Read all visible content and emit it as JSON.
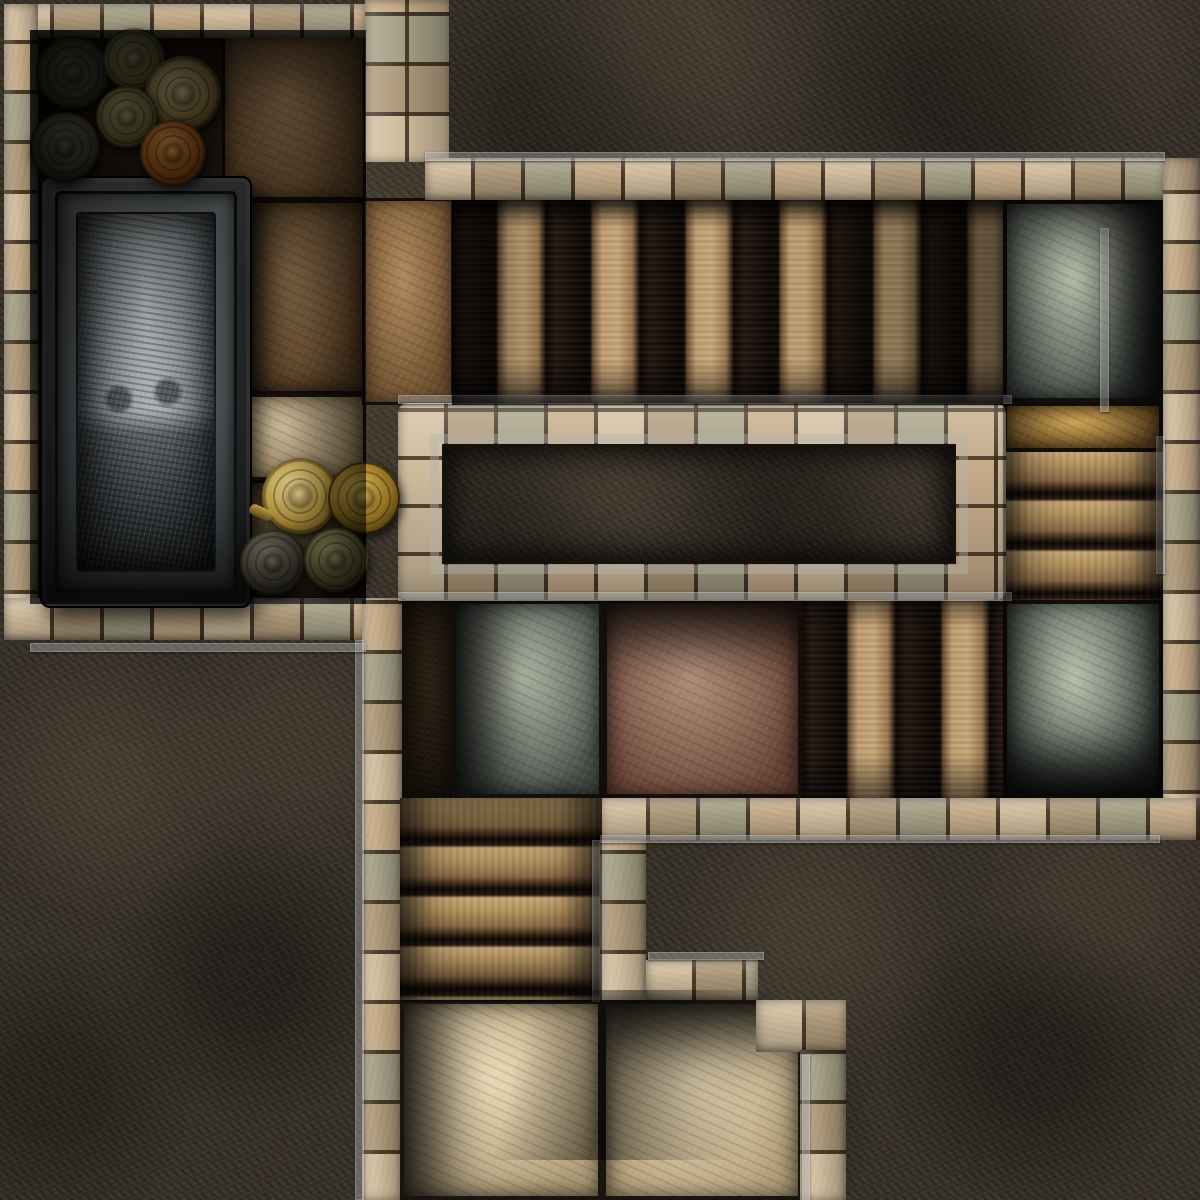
{
  "canvas": {
    "width": 1200,
    "height": 1200
  },
  "map_title": "stone-dungeon-tomb-map",
  "palette": {
    "bedrock": "#3a332a",
    "brick_light": "#d3c1a0",
    "brick_dark": "#a8947a",
    "brick_green": "#8e957f",
    "trim_gray": "#b2b2b2",
    "step_light": "#c8a878",
    "step_gap": "#0d0804",
    "tile_graygreen": "#5d6458",
    "tile_redbrown": "#7c5847",
    "tile_pale": "#cdbd9c",
    "tile_amber": "#8a6a2e",
    "sarcophagus_stone": "#a5acb0",
    "metal_gold": "#c9a94e",
    "metal_bronze": "#8a7340",
    "metal_rust": "#8a4c16"
  },
  "elements": [
    {
      "name": "bedrock",
      "type": "rock",
      "x": 0,
      "y": 0,
      "w": 1200,
      "h": 1200,
      "i": false
    },
    {
      "name": "tomb-room-floor",
      "type": "floor-dark",
      "x": 30,
      "y": 30,
      "w": 336,
      "h": 574,
      "i": false
    },
    {
      "name": "floor-slab-northeast",
      "type": "tile",
      "variant": "slabBrown",
      "x": 222,
      "y": 34,
      "w": 144,
      "h": 166,
      "i": false
    },
    {
      "name": "floor-slab-east",
      "type": "tile",
      "variant": "slabBrown",
      "extra": "shade-left",
      "x": 222,
      "y": 200,
      "w": 144,
      "h": 194,
      "i": false
    },
    {
      "name": "floor-slab-pale",
      "type": "tile",
      "variant": "slabPale",
      "x": 222,
      "y": 394,
      "w": 144,
      "h": 86,
      "i": false
    },
    {
      "name": "floor-slab-southeast",
      "type": "tile",
      "variant": "slabDark",
      "x": 222,
      "y": 480,
      "w": 144,
      "h": 124,
      "i": false
    },
    {
      "name": "corridor-entry-slab",
      "type": "tile",
      "variant": "slabBrown",
      "x": 362,
      "y": 198,
      "w": 92,
      "h": 207,
      "i": false
    },
    {
      "name": "rock-north-field",
      "type": "rock",
      "x": 448,
      "y": 0,
      "w": 752,
      "h": 160,
      "i": false
    },
    {
      "name": "wall-room-top",
      "type": "bricks-h",
      "x": 4,
      "y": 4,
      "w": 362,
      "h": 34,
      "i": false
    },
    {
      "name": "wall-room-left",
      "type": "bricks-v",
      "x": 4,
      "y": 4,
      "w": 34,
      "h": 636,
      "i": false
    },
    {
      "name": "wall-room-right",
      "type": "bricks-v",
      "extra": "grid",
      "x": 365,
      "y": 0,
      "w": 85,
      "h": 162,
      "i": false
    },
    {
      "name": "wall-north-band",
      "type": "bricks-h",
      "x": 425,
      "y": 158,
      "w": 740,
      "h": 42,
      "i": false
    },
    {
      "name": "wall-east",
      "type": "bricks-v",
      "x": 1163,
      "y": 158,
      "w": 37,
      "h": 682,
      "i": false
    },
    {
      "name": "wall-room-bottom",
      "type": "bricks-h",
      "x": 4,
      "y": 598,
      "w": 362,
      "h": 42,
      "i": false
    },
    {
      "name": "wall-west-mid",
      "type": "bricks-v",
      "x": 362,
      "y": 598,
      "w": 40,
      "h": 602,
      "i": false
    },
    {
      "name": "stairs-east-corridor",
      "type": "stairs-v",
      "x": 452,
      "y": 200,
      "w": 551,
      "h": 205,
      "i": false
    },
    {
      "name": "tile-northeast-gray",
      "type": "tile",
      "variant": "graygreen",
      "extra": "shade-right",
      "x": 1003,
      "y": 200,
      "w": 160,
      "h": 202,
      "i": false
    },
    {
      "name": "slab-amber-east",
      "type": "tile",
      "variant": "amber",
      "x": 1003,
      "y": 402,
      "w": 160,
      "h": 50,
      "i": false
    },
    {
      "name": "stairs-east-down",
      "type": "stairs-h",
      "x": 1003,
      "y": 452,
      "w": 160,
      "h": 148,
      "i": false
    },
    {
      "name": "tile-east-gray",
      "type": "tile",
      "variant": "graygreen",
      "extra": "shade-bottom",
      "x": 1003,
      "y": 600,
      "w": 160,
      "h": 198,
      "i": false
    },
    {
      "name": "wall-central-frame",
      "type": "bricks-h",
      "extra": "grid frame",
      "x": 398,
      "y": 403,
      "w": 608,
      "h": 197,
      "i": false
    },
    {
      "name": "trim-central-frame",
      "type": "trimbox",
      "x": 430,
      "y": 434,
      "w": 538,
      "h": 140,
      "i": false
    },
    {
      "name": "rock-central-block",
      "type": "rock",
      "extra": "inset",
      "x": 442,
      "y": 444,
      "w": 514,
      "h": 120,
      "i": false
    },
    {
      "name": "floor-strip-west",
      "type": "floor-dark",
      "x": 402,
      "y": 600,
      "w": 50,
      "h": 198,
      "i": false
    },
    {
      "name": "tile-mid-gray",
      "type": "tile",
      "variant": "graygreen",
      "extra": "shade-left",
      "x": 452,
      "y": 600,
      "w": 151,
      "h": 198,
      "i": false
    },
    {
      "name": "tile-mid-red",
      "type": "tile",
      "variant": "redbrown",
      "extra": "shade-top",
      "x": 603,
      "y": 600,
      "w": 199,
      "h": 198,
      "i": false
    },
    {
      "name": "stairs-mid",
      "type": "stairs-v",
      "x": 802,
      "y": 600,
      "w": 201,
      "h": 198,
      "i": false
    },
    {
      "name": "wall-south-band",
      "type": "bricks-h",
      "x": 600,
      "y": 798,
      "w": 600,
      "h": 42,
      "i": false
    },
    {
      "name": "rock-southeast-field",
      "type": "rock",
      "x": 646,
      "y": 840,
      "w": 554,
      "h": 360,
      "i": false
    },
    {
      "name": "rock-southwest-field",
      "type": "rock",
      "x": 0,
      "y": 640,
      "w": 362,
      "h": 560,
      "i": false
    },
    {
      "name": "stairs-south",
      "type": "stairs-h",
      "x": 400,
      "y": 798,
      "w": 202,
      "h": 204,
      "i": false
    },
    {
      "name": "tile-south-pale-left",
      "type": "tile",
      "variant": "pale",
      "extra": "shade-left",
      "x": 400,
      "y": 1000,
      "w": 202,
      "h": 200,
      "i": false
    },
    {
      "name": "tile-south-pale-right",
      "type": "tile",
      "variant": "pale",
      "extra": "shade-top",
      "x": 602,
      "y": 1000,
      "w": 200,
      "h": 200,
      "i": false
    },
    {
      "name": "wall-step-a",
      "type": "bricks-v",
      "x": 600,
      "y": 840,
      "w": 46,
      "h": 160,
      "i": false
    },
    {
      "name": "wall-step-b",
      "type": "bricks-h",
      "x": 646,
      "y": 960,
      "w": 112,
      "h": 40,
      "i": false
    },
    {
      "name": "wall-step-c",
      "type": "bricks-h",
      "x": 756,
      "y": 1000,
      "w": 90,
      "h": 52,
      "i": false
    },
    {
      "name": "wall-step-d",
      "type": "bricks-v",
      "x": 800,
      "y": 1050,
      "w": 46,
      "h": 150,
      "i": false
    },
    {
      "name": "trim-north-band",
      "type": "trim",
      "x": 425,
      "y": 152,
      "w": 740,
      "h": 9,
      "i": false
    },
    {
      "name": "trim-frame-top",
      "type": "trim",
      "x": 398,
      "y": 395,
      "w": 614,
      "h": 9,
      "i": false
    },
    {
      "name": "trim-frame-bottom",
      "type": "trim",
      "x": 398,
      "y": 592,
      "w": 614,
      "h": 9,
      "i": false
    },
    {
      "name": "trim-west-wall",
      "type": "trim",
      "x": 355,
      "y": 640,
      "w": 9,
      "h": 560,
      "i": false
    },
    {
      "name": "trim-room-bottom",
      "type": "trim",
      "x": 30,
      "y": 643,
      "w": 336,
      "h": 9,
      "i": false
    },
    {
      "name": "trim-south-band",
      "type": "trim",
      "x": 600,
      "y": 835,
      "w": 560,
      "h": 8,
      "i": false
    },
    {
      "name": "trim-step-a",
      "type": "trim",
      "x": 592,
      "y": 840,
      "w": 8,
      "h": 162,
      "i": false
    },
    {
      "name": "trim-step-b",
      "type": "trim",
      "x": 648,
      "y": 952,
      "w": 116,
      "h": 8,
      "i": false
    },
    {
      "name": "trim-step-d",
      "type": "trim",
      "x": 802,
      "y": 1055,
      "w": 8,
      "h": 145,
      "i": false
    },
    {
      "name": "trim-east-wall",
      "type": "trim",
      "x": 1156,
      "y": 436,
      "w": 9,
      "h": 138,
      "i": false
    },
    {
      "name": "trim-east-room",
      "type": "trim",
      "x": 1100,
      "y": 228,
      "w": 9,
      "h": 184,
      "i": false
    },
    {
      "name": "sarcophagus",
      "type": "sarcophagus",
      "x": 40,
      "y": 176,
      "w": 212,
      "h": 432,
      "i": true
    },
    {
      "name": "plate-dark-1",
      "type": "disc",
      "variant": "darkplate",
      "x": 36,
      "y": 36,
      "w": 74,
      "h": 74,
      "i": true
    },
    {
      "name": "urn-green",
      "type": "disc",
      "variant": "green",
      "x": 103,
      "y": 28,
      "w": 62,
      "h": 62,
      "i": true
    },
    {
      "name": "shield-bronze",
      "type": "disc",
      "variant": "bronze",
      "x": 145,
      "y": 56,
      "w": 76,
      "h": 76,
      "i": true
    },
    {
      "name": "plate-green-1",
      "type": "disc",
      "variant": "green",
      "x": 96,
      "y": 86,
      "w": 62,
      "h": 62,
      "i": true
    },
    {
      "name": "plate-dark-2",
      "type": "disc",
      "variant": "darkplate",
      "x": 30,
      "y": 112,
      "w": 70,
      "h": 70,
      "i": true
    },
    {
      "name": "plate-rust",
      "type": "disc",
      "variant": "rust",
      "x": 140,
      "y": 120,
      "w": 66,
      "h": 66,
      "i": true
    },
    {
      "name": "kettle-gold",
      "type": "disc",
      "variant": "gold",
      "extra": "kettle",
      "x": 262,
      "y": 458,
      "w": 76,
      "h": 76,
      "i": true
    },
    {
      "name": "jug-gold",
      "type": "disc",
      "variant": "golddark",
      "x": 328,
      "y": 462,
      "w": 72,
      "h": 72,
      "i": true
    },
    {
      "name": "plate-dark-3",
      "type": "disc",
      "variant": "darkplate",
      "x": 240,
      "y": 530,
      "w": 66,
      "h": 66,
      "i": true
    },
    {
      "name": "plate-green-2",
      "type": "disc",
      "variant": "green",
      "x": 304,
      "y": 528,
      "w": 64,
      "h": 64,
      "i": true
    },
    {
      "name": "shadow-tomb-room",
      "type": "overlay",
      "variant": "room-shadow",
      "x": 30,
      "y": 30,
      "w": 336,
      "h": 574,
      "i": false
    },
    {
      "name": "shadow-east-corridor",
      "type": "overlay",
      "variant": "corridor-shadow",
      "x": 452,
      "y": 200,
      "w": 551,
      "h": 205,
      "i": false
    },
    {
      "name": "shadow-east-column",
      "type": "overlay",
      "variant": "side-shadow",
      "x": 1003,
      "y": 200,
      "w": 160,
      "h": 598,
      "i": false
    },
    {
      "name": "shadow-south-stairs",
      "type": "overlay",
      "variant": "side-shadow",
      "x": 400,
      "y": 798,
      "w": 202,
      "h": 204,
      "i": false
    },
    {
      "name": "shadow-pale-tiles",
      "type": "overlay",
      "variant": "diag-shadow",
      "x": 400,
      "y": 990,
      "w": 404,
      "h": 170,
      "i": false
    }
  ]
}
